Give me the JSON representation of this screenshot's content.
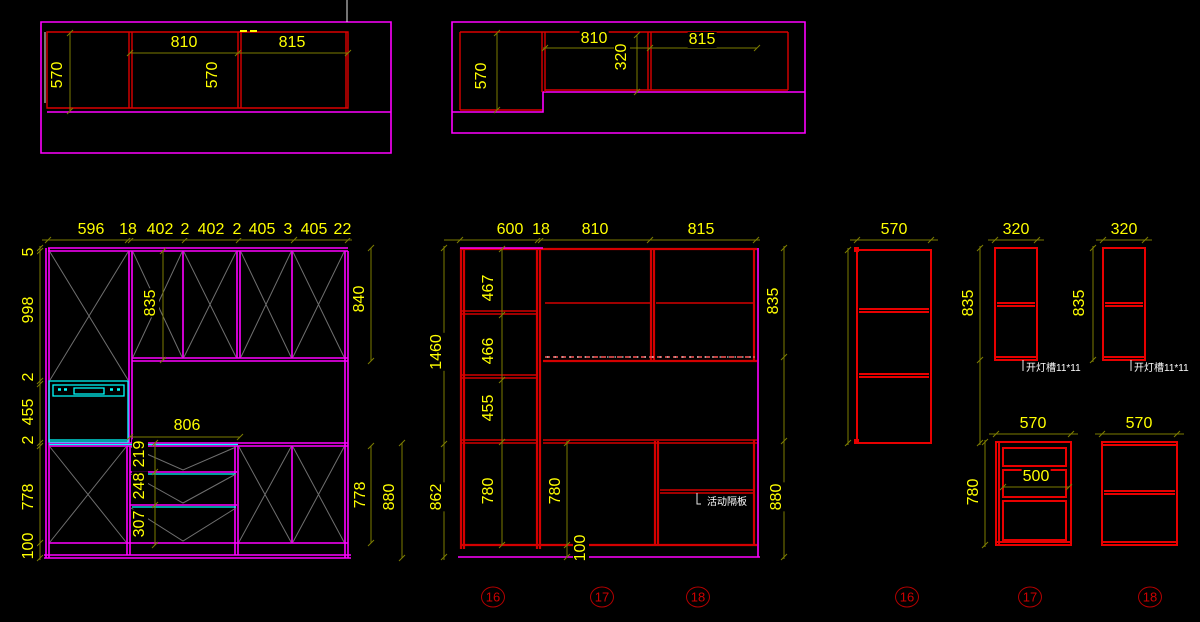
{
  "colors": {
    "background": "#000000",
    "outline_magenta": "#ff00ff",
    "carcass_red": "#d40000",
    "appliance_cyan": "#00ffff",
    "dim_text_yellow": "#ffff00",
    "dim_line_olive": "#7d7d00",
    "door_mark_gray": "#6f6f6f",
    "note_white": "#ffffff",
    "marker_red": "#c00000"
  },
  "plan_left": {
    "d1": "570",
    "w1": "810",
    "w2": "815",
    "d2": "570"
  },
  "plan_right": {
    "d1": "570",
    "w1": "810",
    "d2": "320",
    "w2": "815"
  },
  "elev_left": {
    "top": [
      "596",
      "18",
      "402",
      "2",
      "402",
      "2",
      "405",
      "3",
      "405",
      "2",
      "2"
    ],
    "left": [
      "5",
      "998",
      "2",
      "455",
      "2",
      "778",
      "100"
    ],
    "wall_h": "835",
    "wall_h_r": "840",
    "counter_w": "806",
    "drawers": [
      "219",
      "248",
      "307"
    ],
    "right": [
      "778",
      "880"
    ]
  },
  "elev_mid": {
    "top": [
      "600",
      "18",
      "810",
      "815"
    ],
    "left": [
      "1460",
      "862"
    ],
    "col": [
      "467",
      "466",
      "455",
      "780"
    ],
    "base": [
      "780",
      "100"
    ],
    "right": [
      "835",
      "880"
    ],
    "shelf_note": "活动隔板"
  },
  "sides": {
    "u16_w": "570",
    "u17_w": "320",
    "u17_h": "835",
    "u17_note": "开灯槽11*11",
    "u18_w": "320",
    "u18_h": "835",
    "u18_note": "开灯槽11*11",
    "l17_w": "570",
    "l17_h": "780",
    "l17_inner": "500",
    "l18_w": "570"
  },
  "markers": [
    "16",
    "17",
    "18",
    "16",
    "17",
    "18"
  ]
}
